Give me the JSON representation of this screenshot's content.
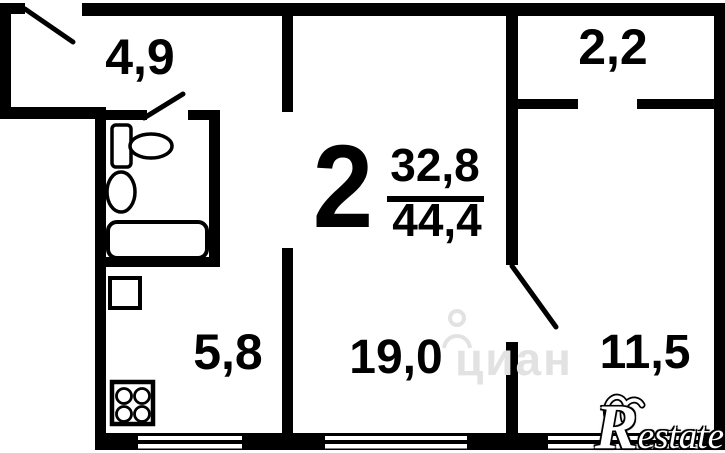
{
  "floorplan": {
    "rooms_count": "2",
    "living_area": "32,8",
    "total_area": "44,4",
    "room_areas": {
      "hallway": "4,9",
      "balcony": "2,2",
      "kitchen": "5,8",
      "living_room": "19,0",
      "bedroom": "11,5"
    },
    "fixtures": [
      "toilet-icon",
      "sink-icon",
      "bathtub-icon",
      "stove-icon",
      "vent-shaft"
    ]
  },
  "watermark": {
    "text": "циан"
  },
  "logo": {
    "text": "Restate",
    "initial": "R",
    "rest": "estate"
  },
  "colors": {
    "walls": "#000000",
    "background": "#ffffff",
    "watermark": "#e2e2e2",
    "logo_text": "#ffffff"
  }
}
